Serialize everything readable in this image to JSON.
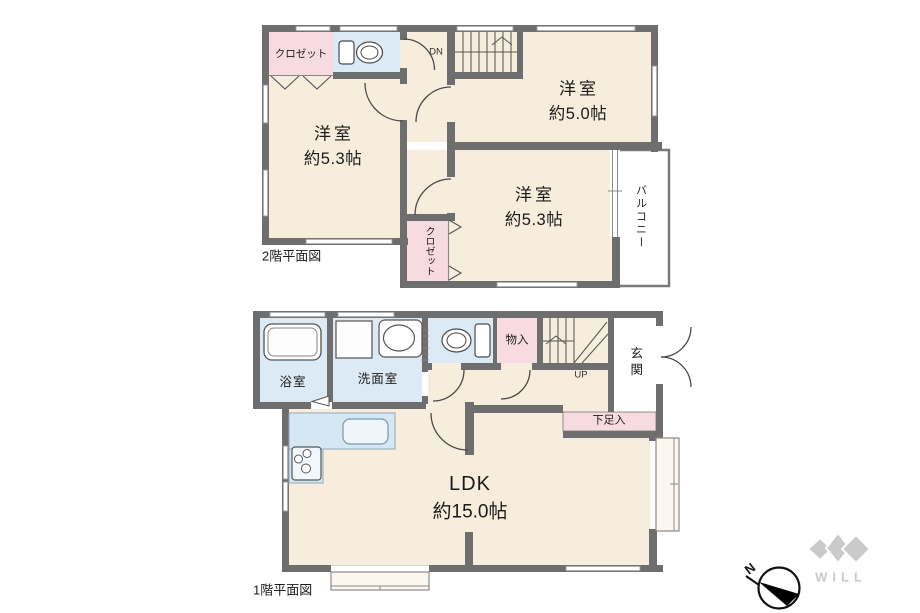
{
  "f2": {
    "title": "2階平面図",
    "closet_top": "クロゼット",
    "closet_bottom": "クロゼット",
    "room_left_name": "洋室",
    "room_left_size": "約5.3帖",
    "room_top_name": "洋室",
    "room_top_size": "約5.0帖",
    "room_mid_name": "洋室",
    "room_mid_size": "約5.3帖",
    "balcony": "バルコニー",
    "stairs": "DN"
  },
  "f1": {
    "title": "1階平面図",
    "bath": "浴室",
    "washroom": "洗面室",
    "storage": "物入",
    "entrance": "玄関",
    "shoe_storage": "下足入",
    "ldk_name": "LDK",
    "ldk_size": "約15.0帖",
    "stairs": "UP"
  },
  "compass": {
    "north": "N"
  },
  "logo": {
    "text": "WILL"
  },
  "colors": {
    "wall": "#6e6e6e",
    "room_floor": "#f6eddc",
    "wet_area": "#dbeaf5",
    "closet_pink": "#f8dbe0",
    "balcony_white": "#ffffff",
    "logo_gray": "#cacaca"
  }
}
